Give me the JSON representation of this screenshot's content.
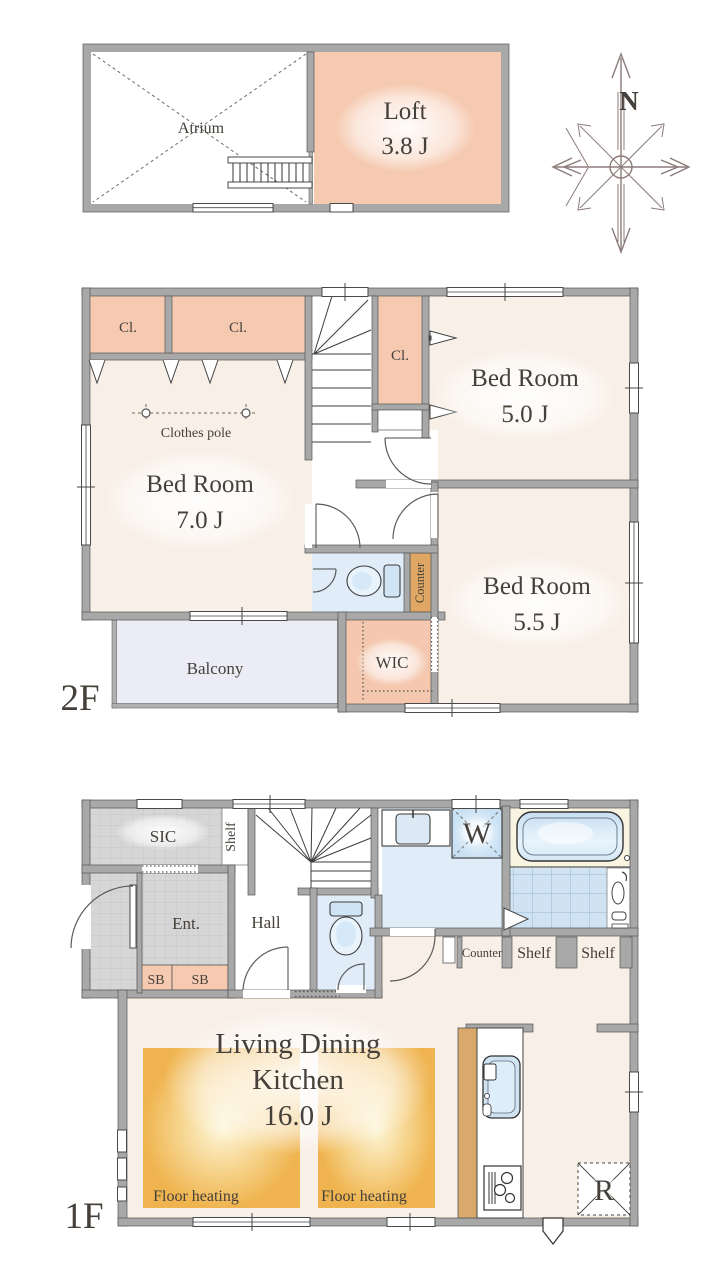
{
  "compass": {
    "north": "N"
  },
  "loft": {
    "atrium": "Atrium",
    "name": "Loft",
    "area": "3.8 J"
  },
  "f2": {
    "floor": "2F",
    "closet1": "Cl.",
    "closet2": "Cl.",
    "closet3": "Cl.",
    "clothes_pole": "Clothes pole",
    "bed7": {
      "name": "Bed Room",
      "area": "7.0 J"
    },
    "bed5": {
      "name": "Bed Room",
      "area": "5.0 J"
    },
    "bed55": {
      "name": "Bed Room",
      "area": "5.5 J"
    },
    "counter": "Counter",
    "wic": "WIC",
    "balcony": "Balcony"
  },
  "f1": {
    "floor": "1F",
    "sic": "SIC",
    "shelf_entry": "Shelf",
    "ent": "Ent.",
    "hall": "Hall",
    "sb1": "SB",
    "sb2": "SB",
    "washer": "W",
    "counter": "Counter",
    "shelf1": "Shelf",
    "shelf2": "Shelf",
    "ldk": {
      "line1": "Living Dining",
      "line2": "Kitchen",
      "area": "16.0 J"
    },
    "floor_heating1": "Floor heating",
    "floor_heating2": "Floor heating",
    "fridge": "R"
  },
  "colors": {
    "wall": "#a8a8a8",
    "peach": "#f6cab1",
    "cream": "#f8efe6",
    "water_blue": "#e0edf8",
    "counter_tan": "#dfa763",
    "balcony": "#ebecf5",
    "floor_heating": "#efb44f",
    "compass": "#8d7b7b"
  }
}
